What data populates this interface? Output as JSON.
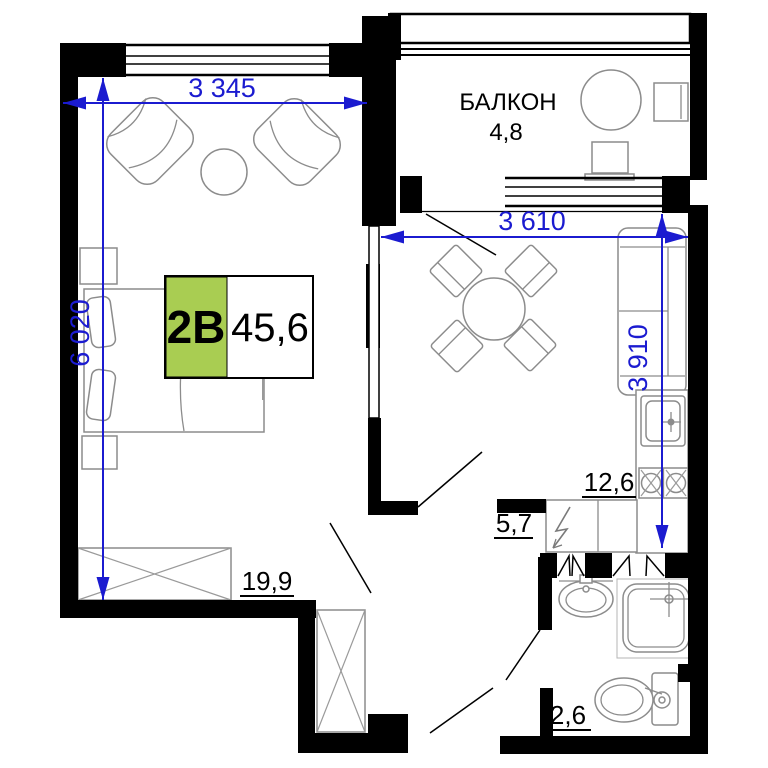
{
  "plan": {
    "tag": {
      "type_label": "2В",
      "total_area": "45,6"
    },
    "rooms": {
      "balcony": {
        "label": "БАЛКОН",
        "area": "4,8"
      },
      "living": {
        "area": "19,9"
      },
      "kitchen": {
        "area": "12,6"
      },
      "hall": {
        "area": "5,7"
      },
      "wc": {
        "area": "2,6"
      }
    },
    "dimensions": {
      "top_width": "3 345",
      "left_height": "6 020",
      "kitchen_width": "3 610",
      "kitchen_height": "3 910"
    },
    "colors": {
      "dimension_blue": "#1b1bd0",
      "tag_green": "#a9cd52",
      "walls": "#000000",
      "furniture_gray": "#8c8c8c"
    }
  }
}
